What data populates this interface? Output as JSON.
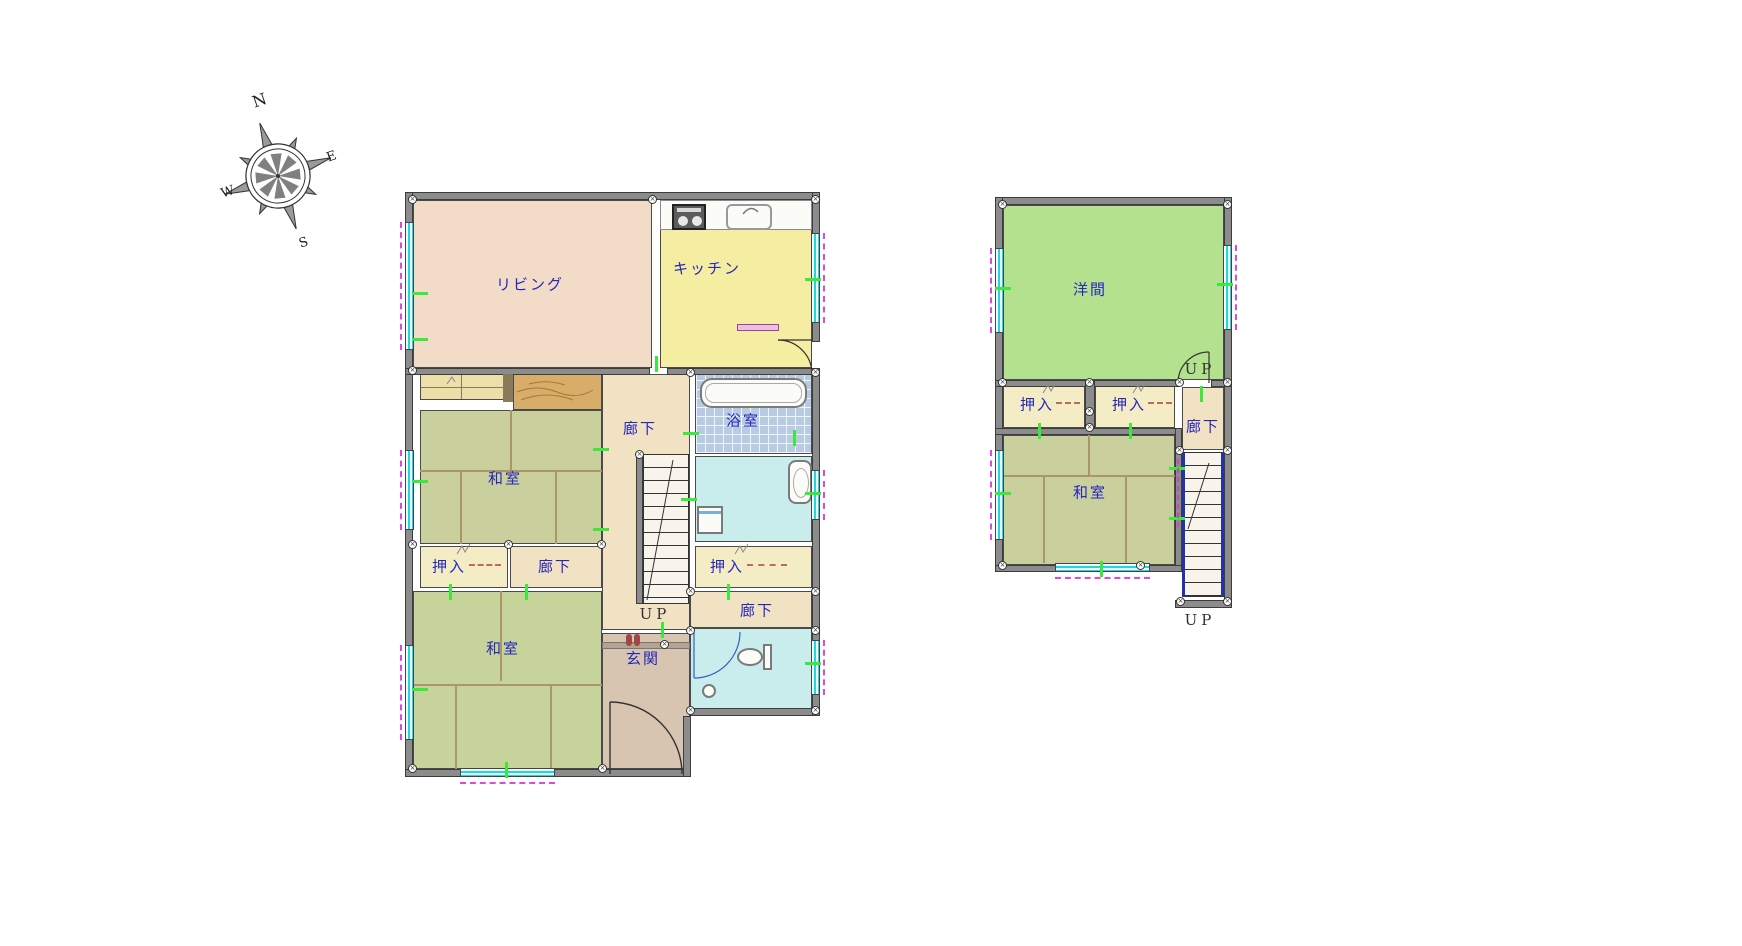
{
  "compass": {
    "n": "N",
    "e": "E",
    "w": "W",
    "s": "S"
  },
  "floor1": {
    "living": "リビング",
    "kitchen": "キッチン",
    "hall_main": "廊下",
    "bath": "浴室",
    "washitsu_middle": "和室",
    "oshiire_left": "押入",
    "hall_small": "廊下",
    "oshiire_right": "押入",
    "washitsu_bottom": "和室",
    "genkan": "玄関",
    "hall_toilet": "廊下",
    "stairs_label": "UP"
  },
  "floor2": {
    "yoma": "洋間",
    "oshiire_left": "押入",
    "oshiire_right": "押入",
    "hall": "廊下",
    "washitsu": "和室",
    "stairs_top_label": "UP",
    "stairs_bottom_label": "UP"
  },
  "glyphs": {
    "joint": "×"
  },
  "colors": {
    "wall": "#8c8c8c",
    "living": "#f2dcc8",
    "kitchen": "#f4eda2",
    "hallway": "#f2e2c4",
    "tatami": "#cad09d",
    "closet": "#f4ecc4",
    "wood_floor": "#d8ad6a",
    "bath_tile": "#b7cbe3",
    "wet_room": "#c9eded",
    "entrance": "#d7c5b1",
    "western_room": "#b3e18e",
    "window_glass": "#22d6e0",
    "window_dash": "#e246e2",
    "label_text": "#2626bb",
    "opening_tick": "#3ce83c"
  }
}
